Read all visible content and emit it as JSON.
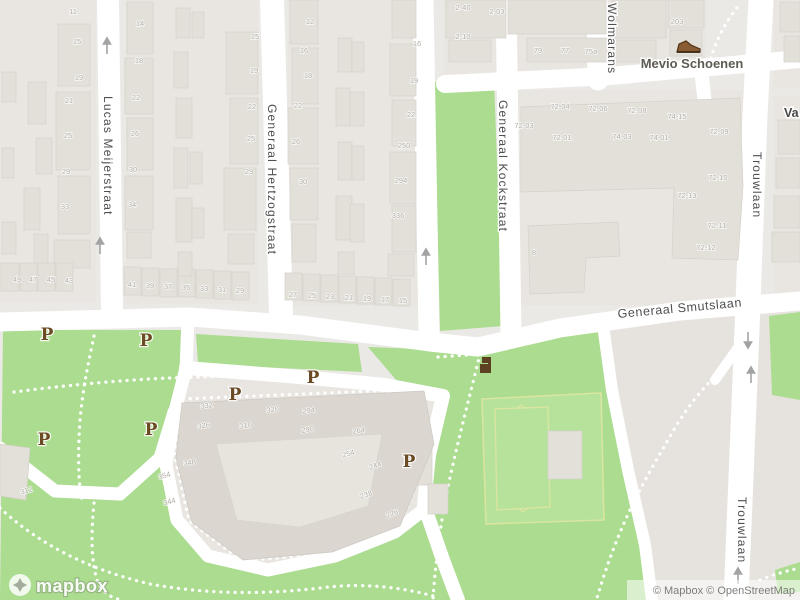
{
  "map": {
    "streets": [
      {
        "label": "Lucas Meijerstraat"
      },
      {
        "label": "Generaal Hertzogstraat"
      },
      {
        "label": "Generaal Kockstraat"
      },
      {
        "label": "Wolmarans"
      },
      {
        "label": "Generaal Smutslaan"
      },
      {
        "label": "Trouwlaan"
      },
      {
        "label": "Trouwlaan"
      },
      {
        "label": "Va"
      }
    ],
    "poi": {
      "name": "Mevio Schoenen",
      "icon": "shoe-icon",
      "icon_color": "#8a5c34"
    },
    "parking": {
      "symbol": "P",
      "color": "#6b4a24",
      "positions": [
        {
          "x": 47,
          "y": 334
        },
        {
          "x": 146,
          "y": 340
        },
        {
          "x": 44,
          "y": 439
        },
        {
          "x": 151,
          "y": 429
        },
        {
          "x": 235,
          "y": 394
        },
        {
          "x": 313,
          "y": 377
        },
        {
          "x": 409,
          "y": 461
        }
      ]
    },
    "arrows": [
      {
        "x": 107,
        "y": 47,
        "dir": "up"
      },
      {
        "x": 100,
        "y": 247,
        "dir": "up"
      },
      {
        "x": 426,
        "y": 258,
        "dir": "up"
      },
      {
        "x": 748,
        "y": 339,
        "dir": "down"
      },
      {
        "x": 751,
        "y": 376,
        "dir": "up"
      },
      {
        "x": 738,
        "y": 577,
        "dir": "up"
      }
    ],
    "house_numbers": [
      {
        "t": "11",
        "x": 73,
        "y": 14
      },
      {
        "t": "15",
        "x": 77,
        "y": 44
      },
      {
        "t": "19",
        "x": 79,
        "y": 80
      },
      {
        "t": "21",
        "x": 69,
        "y": 103
      },
      {
        "t": "25",
        "x": 68,
        "y": 138
      },
      {
        "t": "29",
        "x": 66,
        "y": 174
      },
      {
        "t": "33",
        "x": 65,
        "y": 209
      },
      {
        "t": "14",
        "x": 140,
        "y": 26
      },
      {
        "t": "18",
        "x": 139,
        "y": 63
      },
      {
        "t": "22",
        "x": 136,
        "y": 100
      },
      {
        "t": "26",
        "x": 135,
        "y": 136
      },
      {
        "t": "30",
        "x": 133,
        "y": 172
      },
      {
        "t": "34",
        "x": 132,
        "y": 207
      },
      {
        "t": "49",
        "x": 17,
        "y": 282
      },
      {
        "t": "47",
        "x": 33,
        "y": 282
      },
      {
        "t": "45",
        "x": 51,
        "y": 282
      },
      {
        "t": "43",
        "x": 69,
        "y": 283
      },
      {
        "t": "41",
        "x": 132,
        "y": 287
      },
      {
        "t": "39",
        "x": 150,
        "y": 288
      },
      {
        "t": "37",
        "x": 168,
        "y": 289
      },
      {
        "t": "35",
        "x": 186,
        "y": 290
      },
      {
        "t": "33",
        "x": 204,
        "y": 291
      },
      {
        "t": "31",
        "x": 222,
        "y": 292
      },
      {
        "t": "29",
        "x": 240,
        "y": 293
      },
      {
        "t": "27",
        "x": 293,
        "y": 297
      },
      {
        "t": "25",
        "x": 312,
        "y": 298
      },
      {
        "t": "23",
        "x": 330,
        "y": 299
      },
      {
        "t": "21",
        "x": 349,
        "y": 300
      },
      {
        "t": "19",
        "x": 367,
        "y": 301
      },
      {
        "t": "17",
        "x": 385,
        "y": 302
      },
      {
        "t": "15",
        "x": 403,
        "y": 303
      },
      {
        "t": "15",
        "x": 255,
        "y": 39
      },
      {
        "t": "19",
        "x": 254,
        "y": 73
      },
      {
        "t": "22",
        "x": 252,
        "y": 109
      },
      {
        "t": "25",
        "x": 251,
        "y": 141
      },
      {
        "t": "29",
        "x": 249,
        "y": 174
      },
      {
        "t": "12",
        "x": 310,
        "y": 24
      },
      {
        "t": "16",
        "x": 304,
        "y": 53
      },
      {
        "t": "18",
        "x": 308,
        "y": 78
      },
      {
        "t": "22",
        "x": 298,
        "y": 108
      },
      {
        "t": "26",
        "x": 296,
        "y": 144
      },
      {
        "t": "30",
        "x": 303,
        "y": 184
      },
      {
        "t": "16",
        "x": 417,
        "y": 46
      },
      {
        "t": "19",
        "x": 414,
        "y": 83
      },
      {
        "t": "22",
        "x": 411,
        "y": 117
      },
      {
        "t": "250",
        "x": 404,
        "y": 148
      },
      {
        "t": "294",
        "x": 401,
        "y": 183
      },
      {
        "t": "336",
        "x": 398,
        "y": 218
      },
      {
        "t": "2-40",
        "x": 463,
        "y": 10
      },
      {
        "t": "2-03",
        "x": 497,
        "y": 14
      },
      {
        "t": "2-10",
        "x": 463,
        "y": 39
      },
      {
        "t": "79",
        "x": 538,
        "y": 53
      },
      {
        "t": "77",
        "x": 565,
        "y": 53
      },
      {
        "t": "75a",
        "x": 591,
        "y": 54
      },
      {
        "t": "203",
        "x": 677,
        "y": 24
      },
      {
        "t": "72-04",
        "x": 560,
        "y": 109
      },
      {
        "t": "72-06",
        "x": 598,
        "y": 111
      },
      {
        "t": "72-08",
        "x": 637,
        "y": 113
      },
      {
        "t": "74-15",
        "x": 677,
        "y": 119
      },
      {
        "t": "72-03",
        "x": 524,
        "y": 128
      },
      {
        "t": "72-01",
        "x": 562,
        "y": 140
      },
      {
        "t": "74-03",
        "x": 622,
        "y": 139
      },
      {
        "t": "74-01",
        "x": 659,
        "y": 140
      },
      {
        "t": "72-09",
        "x": 719,
        "y": 134
      },
      {
        "t": "72-10",
        "x": 718,
        "y": 180
      },
      {
        "t": "72-13",
        "x": 687,
        "y": 198
      },
      {
        "t": "72-11",
        "x": 717,
        "y": 228
      },
      {
        "t": "72-12",
        "x": 706,
        "y": 250
      },
      {
        "t": "8",
        "x": 534,
        "y": 255
      },
      {
        "t": "332",
        "x": 207,
        "y": 408,
        "r": -8
      },
      {
        "t": "320",
        "x": 273,
        "y": 412,
        "r": -8
      },
      {
        "t": "294",
        "x": 309,
        "y": 413,
        "r": -8
      },
      {
        "t": "326",
        "x": 204,
        "y": 428,
        "r": -8
      },
      {
        "t": "310",
        "x": 246,
        "y": 428,
        "r": -8
      },
      {
        "t": "290",
        "x": 308,
        "y": 432,
        "r": -8
      },
      {
        "t": "264",
        "x": 359,
        "y": 433,
        "r": -8
      },
      {
        "t": "254",
        "x": 349,
        "y": 456,
        "r": -15
      },
      {
        "t": "348",
        "x": 190,
        "y": 465,
        "r": -8
      },
      {
        "t": "244",
        "x": 376,
        "y": 468,
        "r": -20
      },
      {
        "t": "238",
        "x": 367,
        "y": 497,
        "r": -20
      },
      {
        "t": "226",
        "x": 393,
        "y": 516,
        "r": -20
      },
      {
        "t": "344",
        "x": 170,
        "y": 504,
        "r": -15
      },
      {
        "t": "312",
        "x": 27,
        "y": 493,
        "r": -15
      },
      {
        "t": "354",
        "x": 165,
        "y": 478,
        "r": -15
      }
    ],
    "colors": {
      "land": "#ebe9e5",
      "park": "#abdc90",
      "road": "#ffffff",
      "building": "#e3e0da",
      "pitch_line": "#d9e5a0",
      "parking_p": "#6b4a24"
    }
  },
  "attribution": {
    "text": "© Mapbox © OpenStreetMap"
  },
  "logo": {
    "text": "mapbox"
  }
}
